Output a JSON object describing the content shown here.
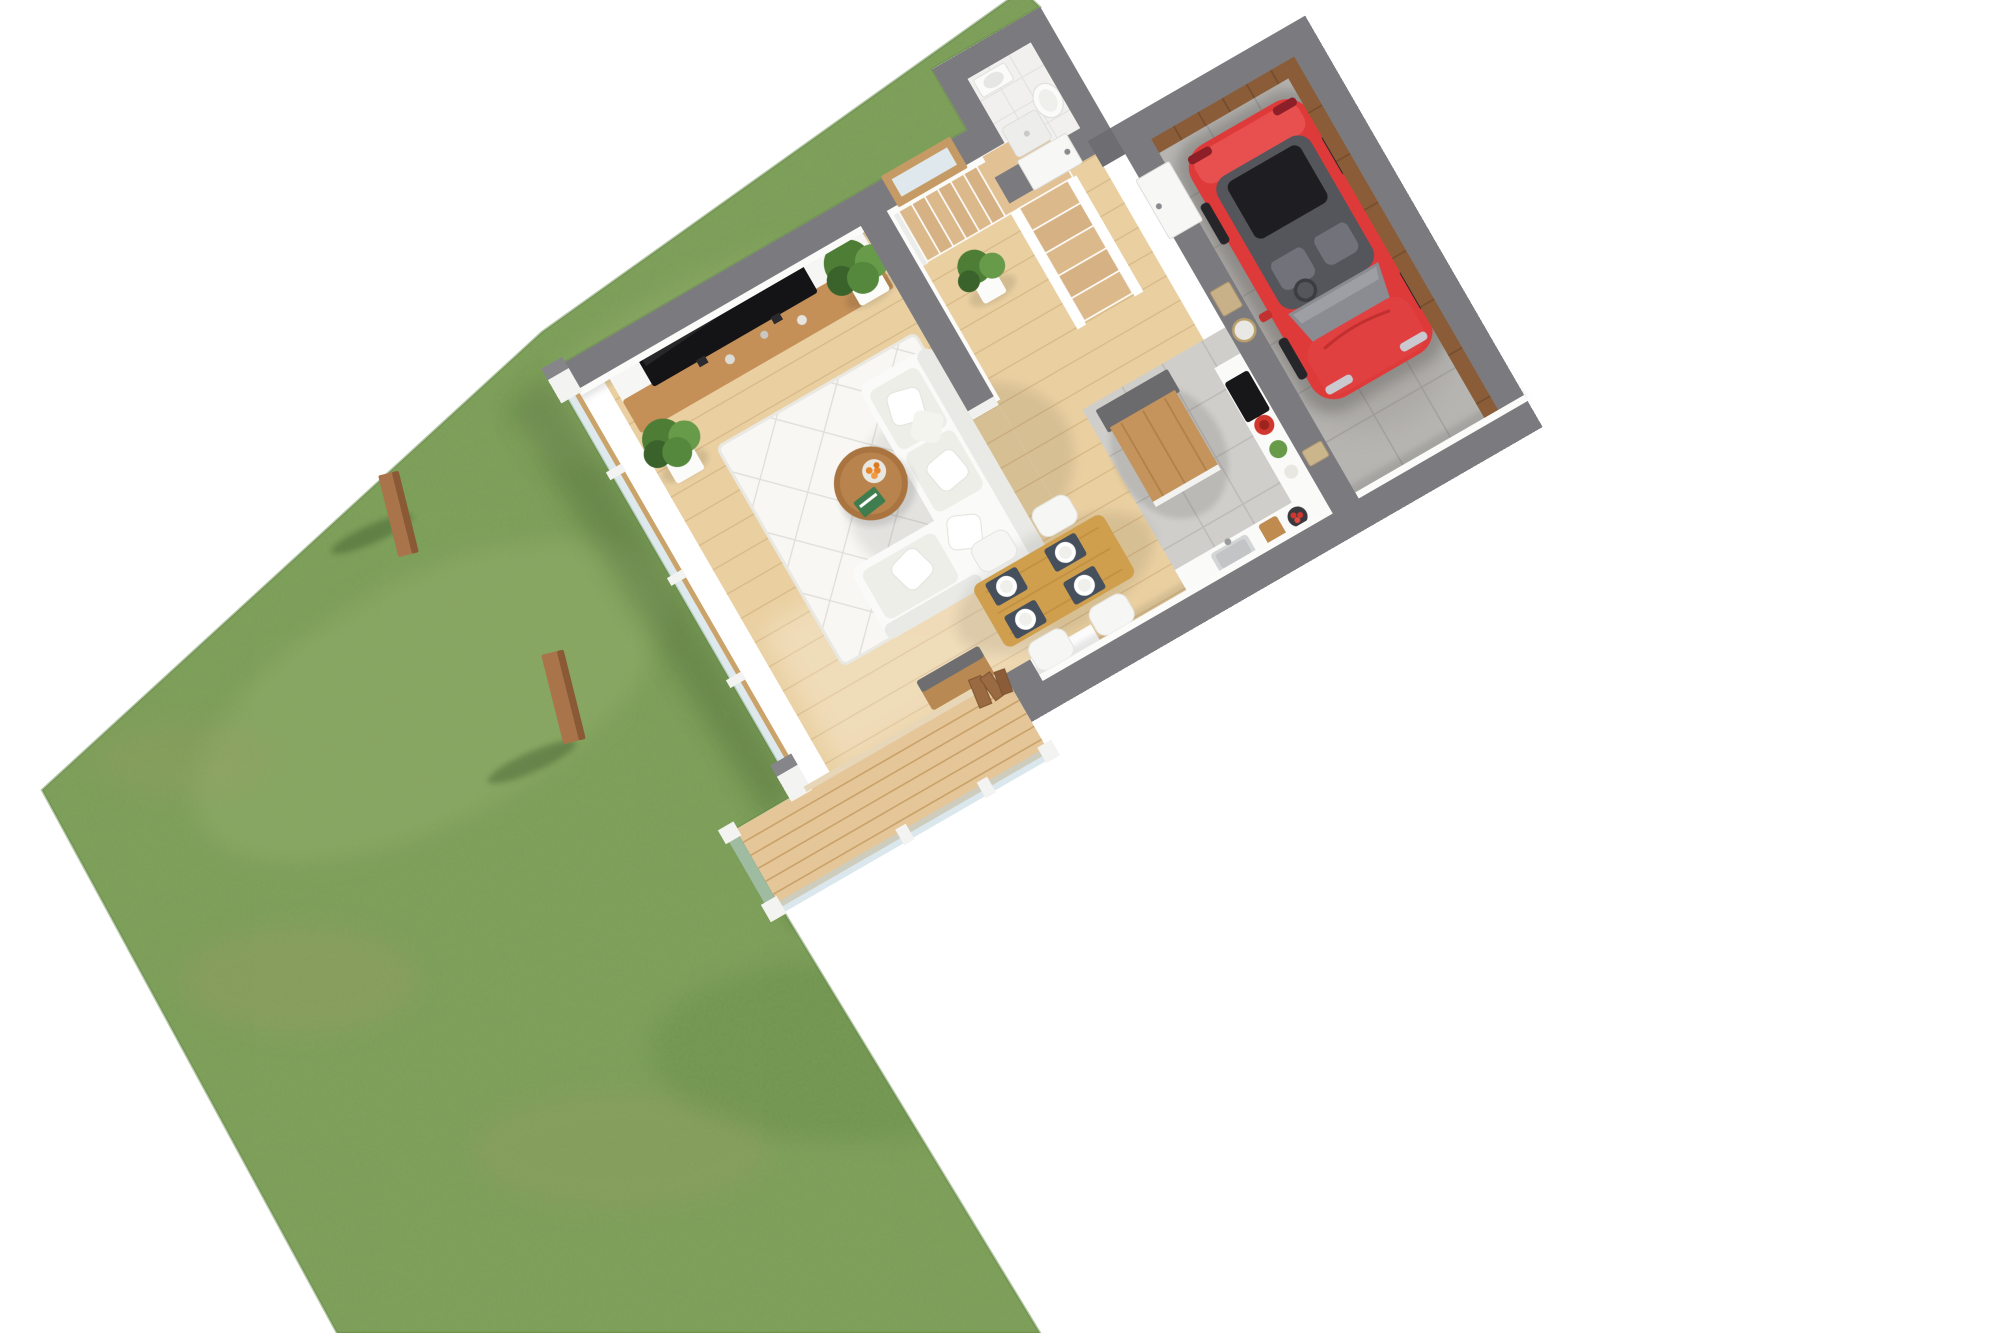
{
  "scene": {
    "type": "isometric-3d-floorplan-render",
    "rooms": [
      "garden",
      "terrace",
      "living-room",
      "dining-area",
      "kitchen",
      "hallway",
      "staircase",
      "bathroom",
      "garage"
    ],
    "furniture": [
      "tv-wall-unit",
      "tv",
      "sofa",
      "coffee-table",
      "rug",
      "dining-table",
      "dining-chairs",
      "kitchen-island",
      "kitchen-counter",
      "sink",
      "stove",
      "toilet",
      "bathroom-sink",
      "potted-plants",
      "pergola-posts",
      "glass-balustrade",
      "folding-doors",
      "interior-doors",
      "stairs",
      "stair-window",
      "light-switch",
      "wall-clock",
      "picture-frame"
    ],
    "counts": {
      "dining_chairs": 4,
      "place_settings": 4,
      "potted_plants": 3,
      "pergola_posts": 2,
      "stair_treads_lower": 5,
      "stair_treads_upper": 6
    },
    "vehicle": {
      "type": "hatchback-car",
      "location": "garage"
    }
  },
  "colors": {
    "background": "#ffffff",
    "grass": "#7b9e57",
    "grass_light": "#92ad69",
    "grass_dark": "#5f854270",
    "grass_patch": "#a39a66",
    "wall_top": "#7b7b7f",
    "wall_cap": "#6e6e72",
    "wall_side": "#f3f3f1",
    "wood_floor": "#ead0a1",
    "wood_floor_line": "#d8b887",
    "deck_wood": "#e5c698",
    "deck_line": "#c9a269",
    "tile_kitchen": "#cfceca",
    "tile_line": "#bdbcb8",
    "concrete": "#b7b5b1",
    "concrete_line": "#a5a39f",
    "bath_floor": "#f1f0ee",
    "bath_tile_line": "#e3e2df",
    "wood_wall": "#8a5c38",
    "wood_wall_dark": "#744c2d",
    "media_wood": "#c49058",
    "tv": "#141416",
    "rug": "#f8f7f3",
    "rug_line": "#d8d7d1",
    "sofa": "#fafaf8",
    "sofa_cushion": "#eeeee9",
    "table_wood": "#cf9f4e",
    "chair": "#f6f6f4",
    "placemat": "#46505c",
    "plate": "#ffffff",
    "island_wood": "#c4945c",
    "island_gray": "#6b6b6e",
    "counter": "#fafaf8",
    "stove": "#17171a",
    "pot_red": "#d0382f",
    "car_red": "#df3a3a",
    "car_red_light": "#e85050",
    "car_dark": "#1e1e22",
    "car_glass": "#55555c",
    "car_gray": "#8b8b92",
    "door": "#f7f7f5",
    "plant": "#4e7d35",
    "plant_light": "#679a49",
    "plant_dark": "#3a632b",
    "pot": "#fbfbf9",
    "stair_tread": "#dcb98b",
    "stair_landing": "#e2c294",
    "glass": "#bcd4dc",
    "post_wood": "#a9744a",
    "post_wood_dark": "#8a5a36",
    "toilet": "#fbfbfa",
    "orange_fruit": "#e8862c",
    "book_green": "#3f7d4e"
  }
}
